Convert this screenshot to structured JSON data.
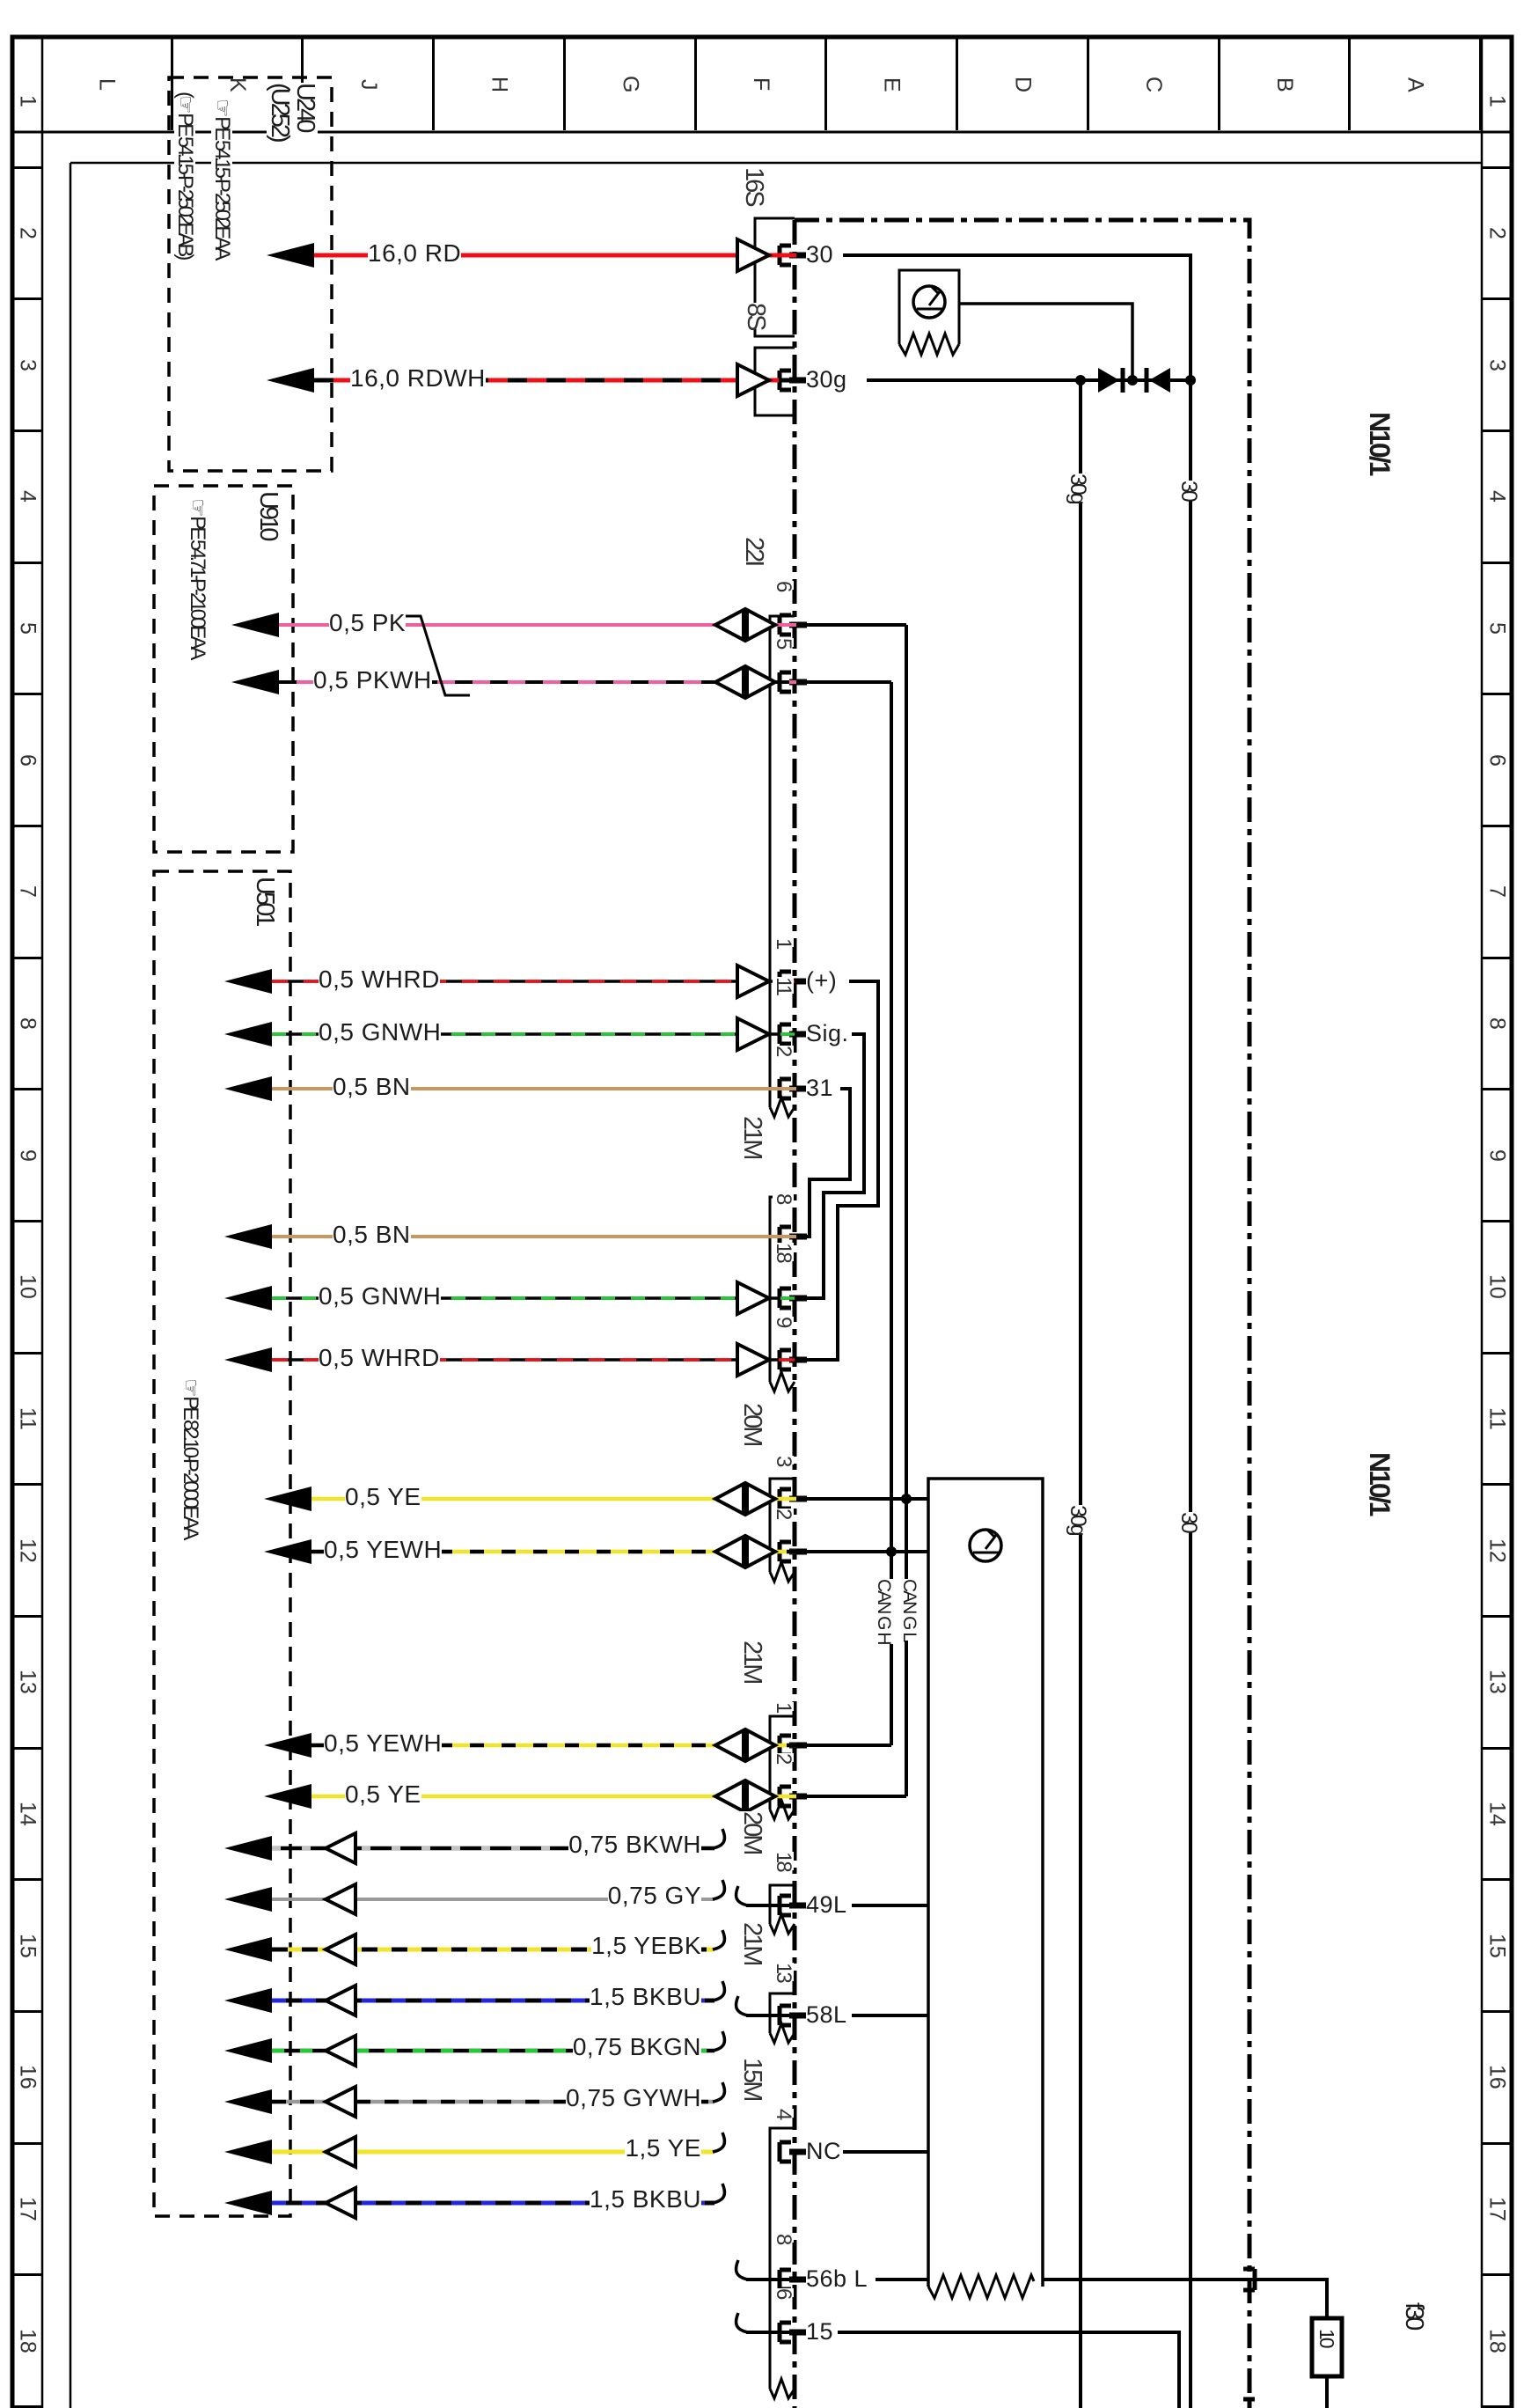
{
  "border": {
    "top_letters": [
      "L",
      "K",
      "J",
      "H",
      "G",
      "F",
      "E",
      "D",
      "C",
      "B",
      "A"
    ],
    "side_numbers": [
      "1",
      "2",
      "3",
      "4",
      "5",
      "6",
      "7",
      "8",
      "9",
      "10",
      "11",
      "12",
      "13",
      "14",
      "15",
      "16",
      "17",
      "18"
    ]
  },
  "boxes": {
    "u240": {
      "id": "U240",
      "id2": "(U252)",
      "ref1": "☞ PE  54.15-P-2502EAA",
      "ref2": "(☞ PE  54.15-P-2502EAB)"
    },
    "u910": {
      "id": "U910",
      "ref1": "☞ PE  54.71-P-2100EAA"
    },
    "u501": {
      "id": "U501",
      "ref1": "☞ PE  82.10-P-2000EAA"
    }
  },
  "unit": {
    "name": "N10/1",
    "name_repeat": "N10/1",
    "fuse_name": "f30",
    "fuse_value": "10"
  },
  "bus": {
    "t30": "30",
    "t30g": "30g",
    "can_h": "CAN G H",
    "can_l": "CAN G L"
  },
  "terminals": {
    "t30": "30",
    "t30g": "30g",
    "plus": "(+)",
    "sig": "Sig.",
    "gnd": "31",
    "l49": "49L",
    "l58": "58L",
    "nc": "NC",
    "l56b": "56b L",
    "t15": "15"
  },
  "connectors": {
    "c16s": "16S",
    "c8s": "8S",
    "c22i": "22I",
    "c21m_a": "21M",
    "c20m_a": "20M",
    "c21m_b": "21M",
    "c20m_b": "20M",
    "c21m_c": "21M",
    "c15m": "15M"
  },
  "pin_numbers": {
    "p6": "6",
    "p5": "5",
    "p1": "1",
    "p11": "11",
    "p2": "2",
    "p8": "8",
    "p18": "18",
    "p9": "9",
    "p3": "3",
    "p2b": "2",
    "p1b": "1",
    "p2c": "2",
    "p18b": "18",
    "p13": "13",
    "p4": "4",
    "p8b": "8",
    "p6b": "6"
  },
  "wires": [
    "16,0 RD",
    "16,0 RDWH",
    "0,5 PK",
    "0,5 PKWH",
    "0,5 WHRD",
    "0,5 GNWH",
    "0,5 BN",
    "0,5 BN",
    "0,5 GNWH",
    "0,5 WHRD",
    "0,5 YE",
    "0,5 YEWH",
    "0,5 YEWH",
    "0,5 YE",
    "0,75 BKWH",
    "0,75 GY",
    "1,5 YEBK",
    "1,5 BKBU",
    "0,75 BKGN",
    "0,75 GYWH",
    "1,5 YE",
    "1,5 BKBU"
  ]
}
